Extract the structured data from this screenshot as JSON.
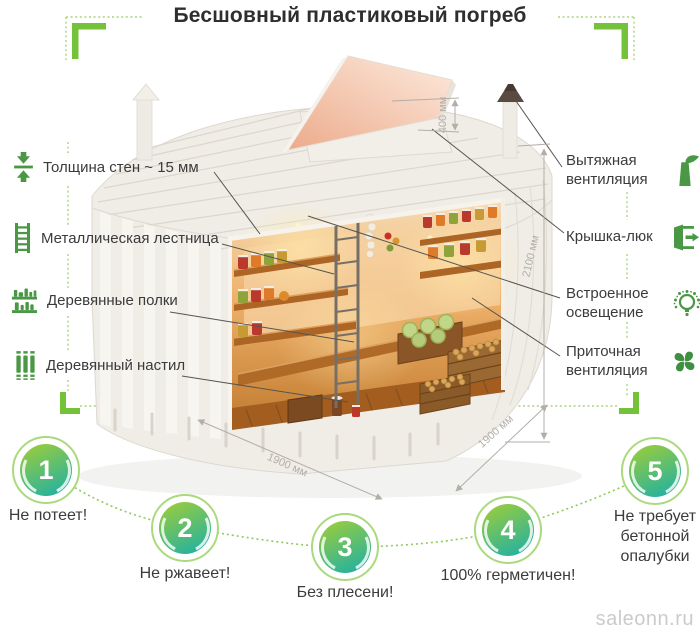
{
  "title": "Бесшовный пластиковый погреб",
  "left_features": [
    {
      "icon": "wall-thickness-icon",
      "label": "Толщина стен ~ 15 мм"
    },
    {
      "icon": "metal-ladder-icon",
      "label": "Металлическая лестница"
    },
    {
      "icon": "wooden-shelves-icon",
      "label": "Деревянные полки"
    },
    {
      "icon": "wooden-floor-icon",
      "label": "Деревянный настил"
    }
  ],
  "right_features": [
    {
      "icon": "exhaust-ventilation-icon",
      "label": "Вытяжная вентиляция"
    },
    {
      "icon": "hatch-lid-icon",
      "label": "Крышка-люк"
    },
    {
      "icon": "built-in-lighting-icon",
      "label": "Встроенное освещение"
    },
    {
      "icon": "supply-ventilation-icon",
      "label": "Приточная вентиляция"
    }
  ],
  "dimensions": {
    "hatch": "400 мм",
    "height": "2100 мм",
    "width": "1900 мм",
    "depth": "1900 мм"
  },
  "benefits": [
    {
      "number": "1",
      "label": "Не потеет!"
    },
    {
      "number": "2",
      "label": "Не ржавеет!"
    },
    {
      "number": "3",
      "label": "Без плесени!"
    },
    {
      "number": "4",
      "label": "100% герметичен!"
    },
    {
      "number": "5",
      "label": "Не требует бетонной опалубки"
    }
  ],
  "watermark": "saleonn.ru",
  "colors": {
    "accent_green": "#74c13a",
    "dotted_green": "#aad47e",
    "icon_green": "#4a9845",
    "circle_gradient_top": "#94cb42",
    "circle_gradient_bottom": "#1fb0a4",
    "text": "#3b3b3b",
    "dimension_gray": "#b3aea7",
    "watermark_gray": "#cbcbcb"
  }
}
